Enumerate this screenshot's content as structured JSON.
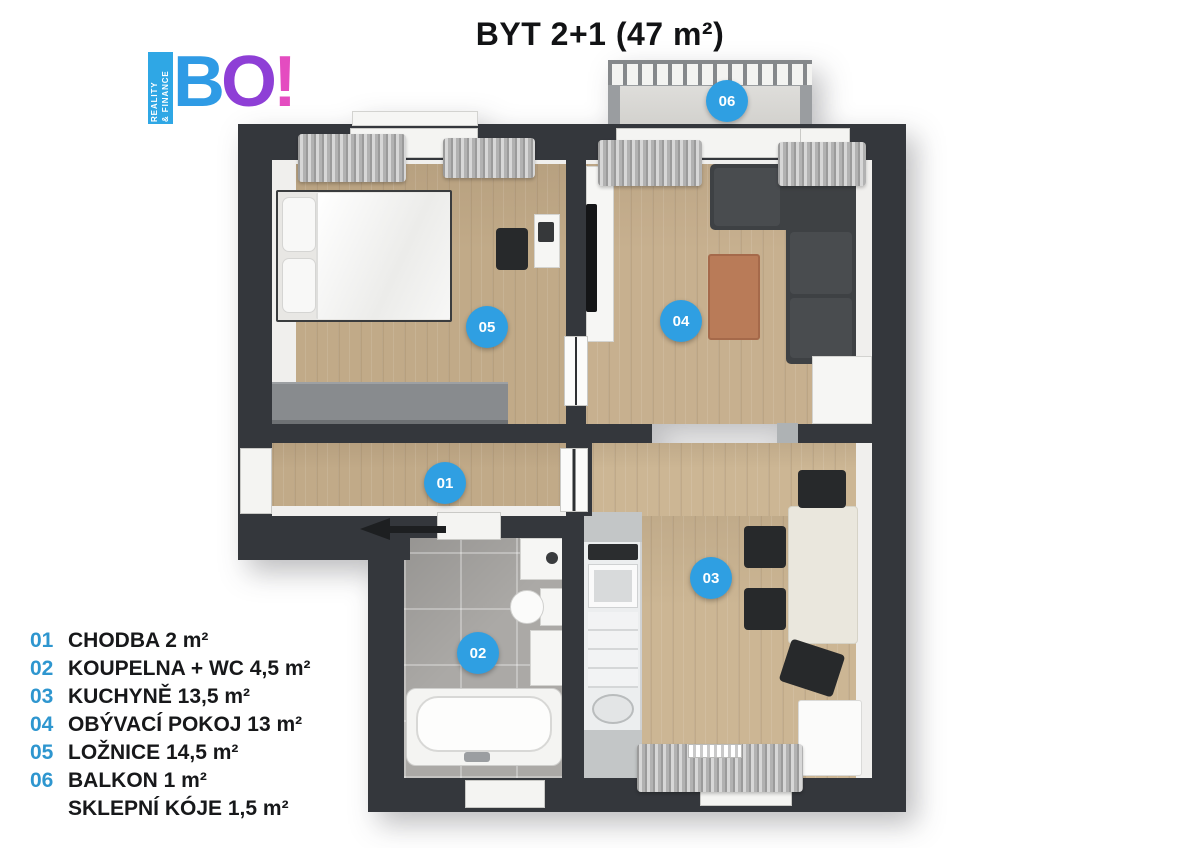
{
  "title": "BYT 2+1 (47 m²)",
  "logo": {
    "tagline_line1": "REALITY",
    "tagline_line2": "& FINANCE",
    "letters": [
      "B",
      "O",
      "!"
    ],
    "colors": {
      "blue": "#2f9be5",
      "purple": "#8e3fd6",
      "pink": "#e44cc0"
    }
  },
  "legend": {
    "number_color": "#2e96cf",
    "items": [
      {
        "num": "01",
        "label": "CHODBA 2 m²"
      },
      {
        "num": "02",
        "label": "KOUPELNA + WC 4,5 m²"
      },
      {
        "num": "03",
        "label": "KUCHYNĚ 13,5 m²"
      },
      {
        "num": "04",
        "label": "OBÝVACÍ POKOJ 13 m²"
      },
      {
        "num": "05",
        "label": "LOŽNICE 14,5 m²"
      },
      {
        "num": "06",
        "label": "BALKON 1 m²"
      },
      {
        "num": "",
        "label": "SKLEPNÍ KÓJE 1,5 m²"
      }
    ]
  },
  "markers": {
    "color": "#2f9fe2",
    "items": [
      {
        "num": "01"
      },
      {
        "num": "02"
      },
      {
        "num": "03"
      },
      {
        "num": "04"
      },
      {
        "num": "05"
      },
      {
        "num": "06"
      }
    ]
  },
  "palette": {
    "wall": "#34373c",
    "wood_floor": "#c7b08f",
    "bath_tile": "#aba9a6",
    "balcony_floor": "#d8d7d3",
    "accent_blue": "#2f9fe2"
  }
}
